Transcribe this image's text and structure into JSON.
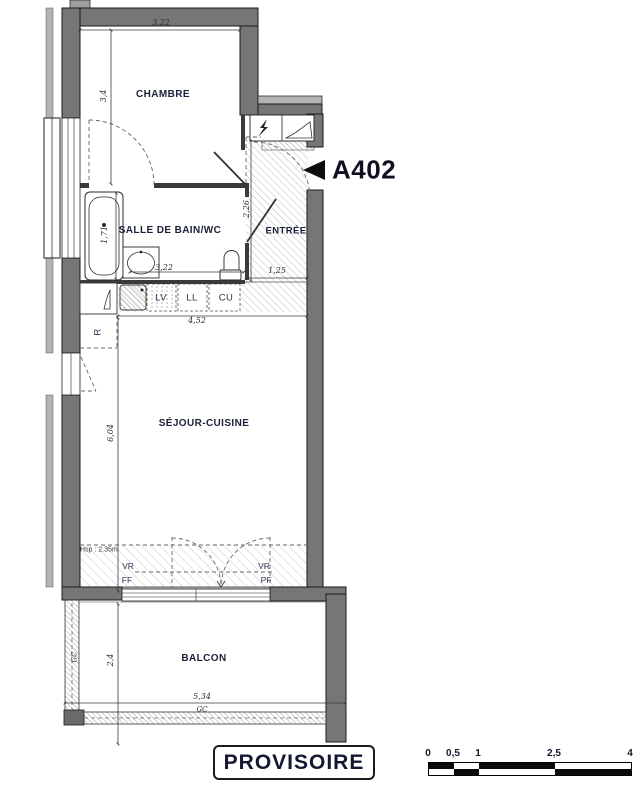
{
  "unit": {
    "label": "A402"
  },
  "rooms": {
    "chambre": "CHAMBRE",
    "salle_de_bain": "SALLE DE BAIN/WC",
    "entree": "ENTRÉE",
    "sejour_cuisine": "SÉJOUR-CUISINE",
    "balcon": "BALCON"
  },
  "appliances": {
    "lv": "LV",
    "ll": "LL",
    "cu": "CU",
    "refrigerateur": "R"
  },
  "annotations": {
    "hauteur_sous_plafond": "Hsp : 2.35m",
    "vr_left": "VR",
    "ff": "FF",
    "vr_right": "VR",
    "pf": "PF",
    "gc_left": "GC",
    "gc_bottom": "GC"
  },
  "dimensions": {
    "chambre_largeur": "3,22",
    "chambre_hauteur": "3,4",
    "bain_hauteur": "1,71",
    "bain_largeur": "3,22",
    "entree_hauteur": "2,26",
    "entree_largeur": "1,25",
    "cuisine_largeur": "4,52",
    "sejour_hauteur": "6,04",
    "balcon_hauteur": "2,4",
    "balcon_largeur": "5,34"
  },
  "stamp": {
    "label": "PROVISOIRE"
  },
  "scalebar": {
    "labels": [
      "0",
      "0,5",
      "1",
      "2,5",
      "4"
    ]
  },
  "colors": {
    "wall": "#767676",
    "wall_light": "#b3b3b3",
    "label": "#1b2138",
    "line": "#333333"
  }
}
